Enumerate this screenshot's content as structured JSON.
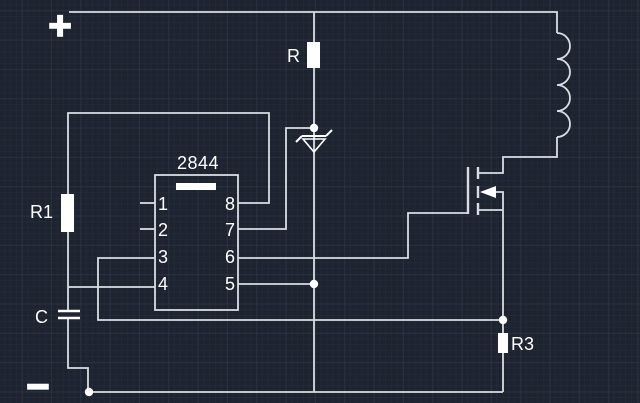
{
  "canvas": {
    "bg": "#1d2430",
    "grid_minor": "#222937",
    "grid_major": "#293140",
    "wire": "#d9dde3",
    "symbol": "#ffffff"
  },
  "labels": {
    "plus": "+",
    "minus": "−",
    "r_top": "R",
    "r1": "R1",
    "c": "C",
    "r3": "R3",
    "ic_part": "2844"
  },
  "pins": [
    "1",
    "2",
    "3",
    "4",
    "5",
    "6",
    "7",
    "8"
  ],
  "schematic": {
    "wires": [
      {
        "name": "vplus-rail",
        "pts": [
          [
            69,
            12
          ],
          [
            557,
            12
          ],
          [
            557,
            33
          ]
        ]
      },
      {
        "name": "coil-to-drain",
        "pts": [
          [
            557,
            137
          ],
          [
            557,
            157
          ],
          [
            503,
            157
          ],
          [
            503,
            173
          ],
          [
            478,
            173
          ]
        ]
      },
      {
        "name": "center-column",
        "pts": [
          [
            314,
            12
          ],
          [
            314,
            392
          ]
        ]
      },
      {
        "name": "zener-to-pin7",
        "pts": [
          [
            314,
            128
          ],
          [
            286,
            128
          ],
          [
            286,
            229
          ],
          [
            238,
            229
          ]
        ]
      },
      {
        "name": "pin8-to-r1",
        "pts": [
          [
            238,
            203
          ],
          [
            269,
            203
          ],
          [
            269,
            113
          ],
          [
            68,
            113
          ],
          [
            68,
            194
          ]
        ]
      },
      {
        "name": "r1-to-cap",
        "pts": [
          [
            68,
            232
          ],
          [
            68,
            311
          ]
        ]
      },
      {
        "name": "cap-to-gnd",
        "pts": [
          [
            68,
            318
          ],
          [
            68,
            368
          ],
          [
            88,
            368
          ],
          [
            88,
            392
          ]
        ]
      },
      {
        "name": "gnd-rail",
        "pts": [
          [
            89,
            392
          ],
          [
            503,
            392
          ]
        ]
      },
      {
        "name": "source-column",
        "pts": [
          [
            503,
            210
          ],
          [
            503,
            392
          ]
        ]
      },
      {
        "name": "pin4-wire",
        "pts": [
          [
            68,
            287
          ],
          [
            155,
            287
          ]
        ]
      },
      {
        "name": "pin3-sense-wire",
        "pts": [
          [
            155,
            258
          ],
          [
            98,
            258
          ],
          [
            98,
            320
          ],
          [
            503,
            320
          ]
        ]
      },
      {
        "name": "pin6-to-gate",
        "pts": [
          [
            238,
            258
          ],
          [
            408,
            258
          ],
          [
            408,
            213
          ],
          [
            468,
            213
          ]
        ]
      },
      {
        "name": "pin5-wire",
        "pts": [
          [
            238,
            284
          ],
          [
            314,
            284
          ]
        ]
      },
      {
        "name": "pin1-stub",
        "pts": [
          [
            140,
            203
          ],
          [
            155,
            203
          ]
        ]
      },
      {
        "name": "pin2-stub",
        "pts": [
          [
            140,
            229
          ],
          [
            155,
            229
          ]
        ]
      },
      {
        "name": "mosfet-body-link",
        "pts": [
          [
            496,
            192
          ],
          [
            503,
            192
          ],
          [
            503,
            210
          ]
        ]
      },
      {
        "name": "mosfet-source-stub",
        "pts": [
          [
            478,
            210
          ],
          [
            503,
            210
          ]
        ]
      }
    ],
    "coil": {
      "x": 557,
      "y_start": 33,
      "bumps": 4,
      "radius": 13
    },
    "resistors": [
      {
        "id": "R",
        "x": 307,
        "y": 42,
        "w": 13,
        "h": 26
      },
      {
        "id": "R1",
        "x": 61,
        "y": 194,
        "w": 13,
        "h": 38
      },
      {
        "id": "R3",
        "x": 498,
        "y": 333,
        "w": 10,
        "h": 20
      }
    ],
    "capacitor": {
      "plates": [
        [
          58,
          311,
          80,
          311
        ],
        [
          58,
          318,
          80,
          318
        ]
      ]
    },
    "ic": {
      "box": [
        155,
        175,
        83,
        135
      ],
      "notch": [
        176,
        183,
        40,
        7
      ]
    },
    "zener": {
      "bar": [
        302,
        136,
        326,
        136
      ],
      "wing_left": [
        302,
        136,
        296,
        142
      ],
      "wing_right": [
        326,
        136,
        332,
        130
      ],
      "triangle": [
        [
          303,
          139
        ],
        [
          325,
          139
        ],
        [
          314,
          152
        ]
      ]
    },
    "mosfet": {
      "gate_bar": [
        468,
        167,
        468,
        214
      ],
      "channel": [
        [
          478,
          167,
          478,
          179
        ],
        [
          478,
          186,
          478,
          198
        ],
        [
          478,
          203,
          478,
          215
        ]
      ],
      "arrow": [
        [
          480,
          192
        ],
        [
          496,
          186
        ],
        [
          496,
          198
        ]
      ]
    },
    "junctions": [
      [
        314,
        128
      ],
      [
        314,
        284
      ],
      [
        503,
        320
      ],
      [
        89,
        392
      ]
    ]
  }
}
